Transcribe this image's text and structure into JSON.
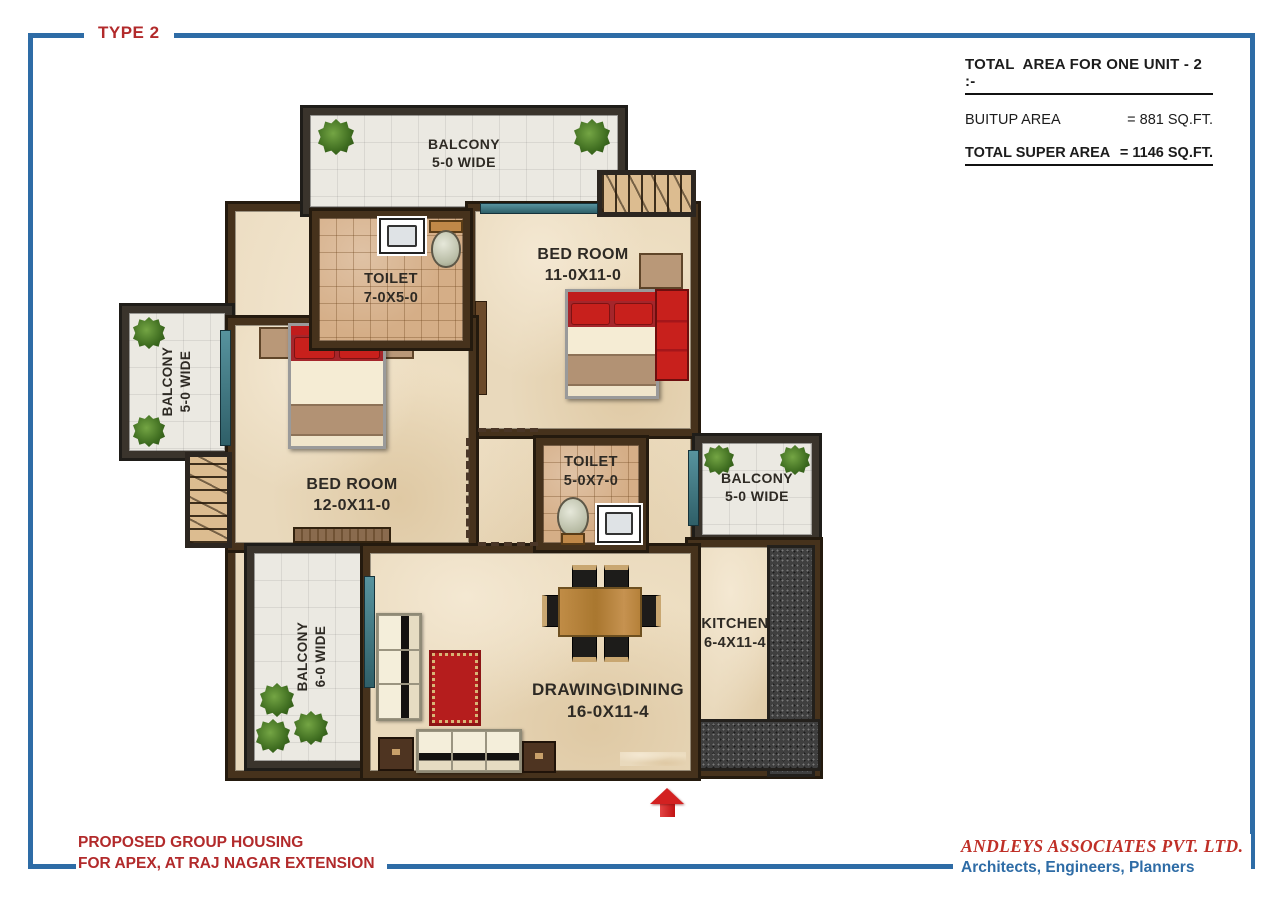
{
  "page": {
    "type_label": "TYPE 2",
    "footer": {
      "left_line1": "PROPOSED GROUP HOUSING",
      "left_line2": "FOR APEX, AT RAJ NAGAR EXTENSION",
      "company": "ANDLEYS ASSOCIATES PVT. LTD.",
      "tagline": "Architects, Engineers, Planners"
    }
  },
  "area_summary": {
    "title": "TOTAL  AREA FOR ONE UNIT - 2 :-",
    "rows": [
      {
        "label": "BUITUP AREA",
        "value": "=  881 SQ.FT."
      },
      {
        "label": "TOTAL SUPER AREA",
        "value": "=  1146 SQ.FT."
      }
    ]
  },
  "rooms": {
    "balcony_top": {
      "label": "BALCONY",
      "size": "5-0 WIDE"
    },
    "toilet_1": {
      "label": "TOILET",
      "size": "7-0X5-0"
    },
    "bedroom_1": {
      "label": "BED ROOM",
      "size": "11-0X11-0"
    },
    "balcony_left": {
      "label": "BALCONY",
      "size": "5-0 WIDE"
    },
    "bedroom_2": {
      "label": "BED ROOM",
      "size": "12-0X11-0"
    },
    "toilet_2": {
      "label": "TOILET",
      "size": "5-0X7-0"
    },
    "balcony_right": {
      "label": "BALCONY",
      "size": "5-0 WIDE"
    },
    "balcony_bottom": {
      "label": "BALCONY",
      "size": "6-0 WIDE"
    },
    "drawing_dining": {
      "label": "DRAWING\\DINING",
      "size": "16-0X11-4"
    },
    "kitchen": {
      "label": "KITCHEN",
      "size": "6-4X11-4"
    }
  },
  "colors": {
    "frame_blue": "#2e6ca6",
    "heading_red": "#b22a2b",
    "wall_brown": "#46321c",
    "balcony_wall": "#3a342c",
    "floor_marble": "#e9d9bc",
    "toilet_tile": "#d5ae87",
    "granite_dark": "#3f3f3f",
    "furniture_red": "#c01c1c",
    "window_teal": "#3f7a86",
    "plant_green": "#3d6b1f"
  }
}
